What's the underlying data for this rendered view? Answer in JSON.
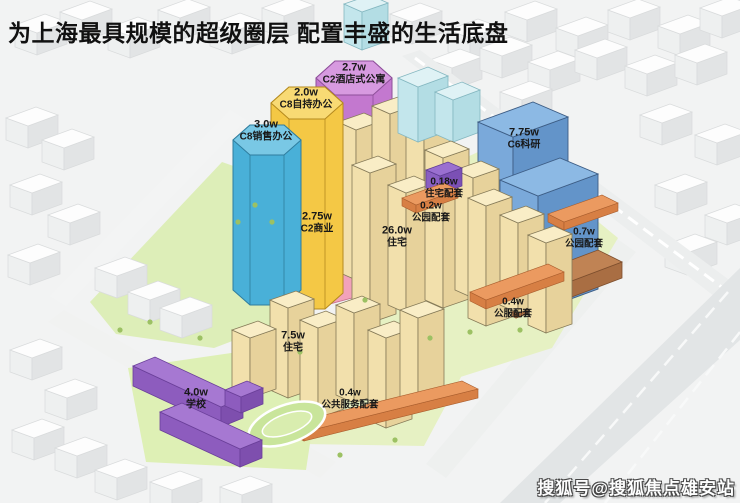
{
  "title": "为上海最具规模的超级圈层  配置丰盛的生活底盘",
  "watermark": "搜狐号@搜狐焦点雄安站",
  "palette": {
    "title_color": "#111111",
    "residential_cream": "#f7e7bd",
    "commercial_pink": "#f2a2ba",
    "sales_office_blue": "#49b0d8",
    "self_held_office_yellow": "#f4c845",
    "serviced_apartment_purple": "#c378cf",
    "research_blue": "#7aa9da",
    "school_purple": "#a678d2",
    "amenity_orange": "#eb9a60",
    "residential_amenity_violet": "#9a6fd0",
    "park_green": "#ddeeb8",
    "cyan_buildings": "#d4eef3",
    "watermark_color": "#ffffff"
  },
  "map": {
    "parcels": [
      {
        "area": "3.0w",
        "use": "C8销售办公",
        "color": "#49b0d8"
      },
      {
        "area": "2.0w",
        "use": "C8自持办公",
        "color": "#f4c845"
      },
      {
        "area": "2.7w",
        "use": "C2酒店式公寓",
        "color": "#c378cf"
      },
      {
        "area": "7.75w",
        "use": "C6科研",
        "color": "#7aa9da"
      },
      {
        "area": "0.18w",
        "use": "住宅配套",
        "color": "#9a6fd0"
      },
      {
        "area": "0.2w",
        "use": "公园配套",
        "color": "#eb9a60"
      },
      {
        "area": "2.75w",
        "use": "C2商业",
        "color": "#f2a2ba"
      },
      {
        "area": "26.0w",
        "use": "住宅",
        "color": "#f7e7bd"
      },
      {
        "area": "0.7w",
        "use": "公园配套",
        "color": "#eb9a60"
      },
      {
        "area": "0.4w",
        "use": "公服配套",
        "color": "#eb9a60"
      },
      {
        "area": "7.5w",
        "use": "住宅",
        "color": "#f7e7bd"
      },
      {
        "area": "4.0w",
        "use": "学校",
        "color": "#a678d2"
      },
      {
        "area": "0.4w",
        "use": "公共服务配套",
        "color": "#eb9a60"
      }
    ]
  }
}
